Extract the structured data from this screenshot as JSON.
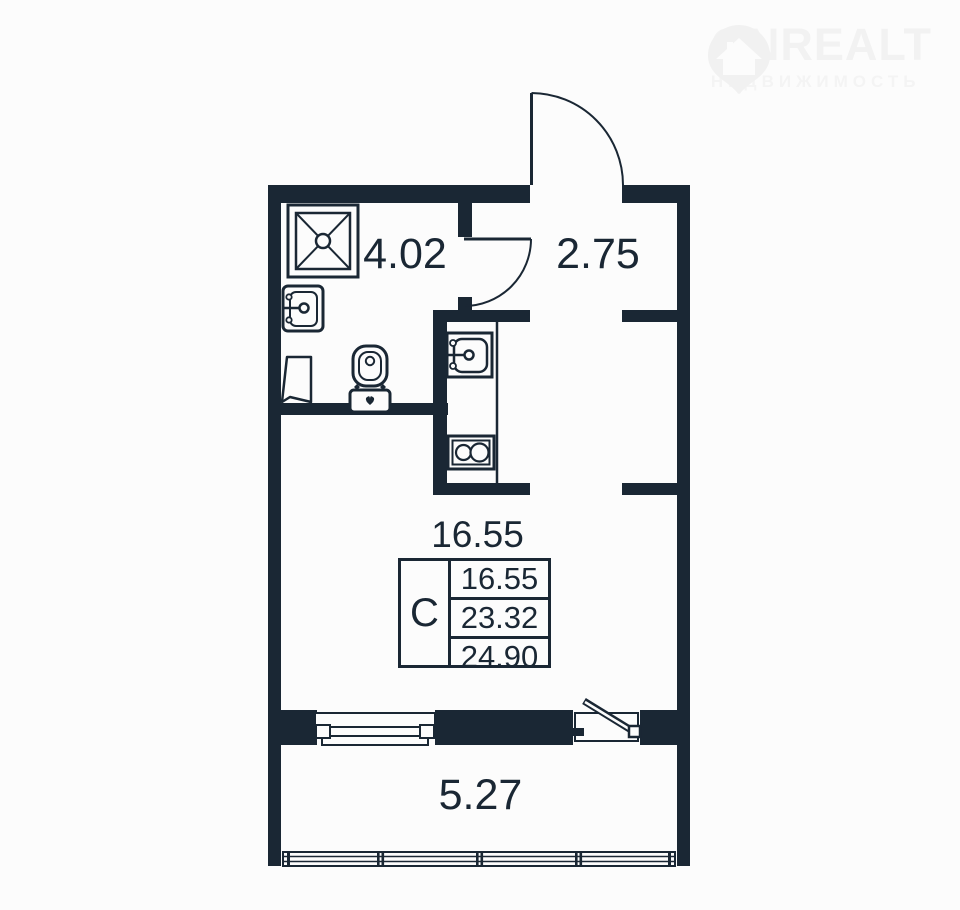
{
  "watermark": {
    "brand": "ONREALT",
    "tagline": "НЕДВИЖИМОСТЬ",
    "icon": "map-pin-house-icon"
  },
  "colors": {
    "ink": "#1a2734",
    "background": "#fcfcfc",
    "watermark": "#f2f2f2"
  },
  "rooms": {
    "bathroom": {
      "area": "4.02"
    },
    "hallway": {
      "area": "2.75"
    },
    "living": {
      "area": "16.55"
    },
    "balcony": {
      "area": "5.27"
    }
  },
  "info_table": {
    "type": "С",
    "living_area": "16.55",
    "area": "23.32",
    "total_area": "24.90"
  },
  "fixtures": [
    "shower-icon",
    "bathroom-sink-icon",
    "toilet-icon",
    "cabinet-icon",
    "kitchen-sink-icon",
    "stove-icon",
    "kitchen-counter",
    "entrance-door",
    "bathroom-door",
    "balcony-door",
    "window",
    "balcony-glazing"
  ]
}
